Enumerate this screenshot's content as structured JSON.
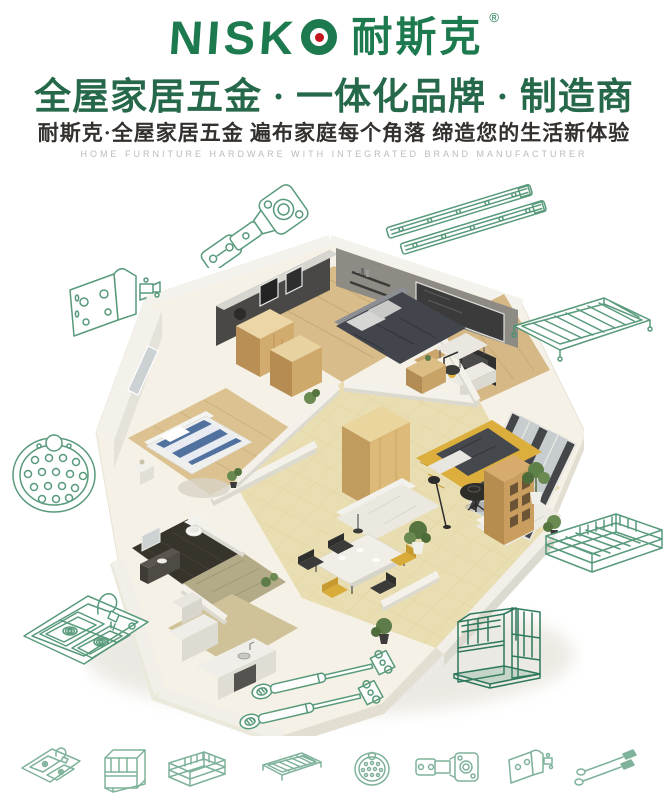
{
  "brand": {
    "wordmark": "NISKO",
    "wordmark_prefix": "NISK",
    "wordmark_last_letter": "O",
    "cn_name": "耐斯克",
    "registered_mark": "®"
  },
  "header": {
    "headline": "全屋家居五金 · 一体化品牌 · 制造商",
    "subheadline": "耐斯克·全屋家居五金  遍布家庭每个角落  缔造您的生活新体验",
    "tagline_en": "HOME FURNITURE HARDWARE WITH INTEGRATED BRAND MANUFACTURER"
  },
  "illustrations": {
    "center_image": "isometric-apartment-cutaway-render",
    "products_lineart": [
      "concealed-hinge",
      "drawer-slide-rails",
      "corner-bracket",
      "wire-shelf-rack",
      "perforated-round-plate",
      "wire-basket",
      "double-bowl-sink-with-faucet",
      "gas-lift-struts",
      "wire-organizer-rack"
    ],
    "bottom_icons": [
      "double-bowl-sink",
      "wire-organizer-rack",
      "wire-basket",
      "wire-shelf-rack",
      "perforated-round-plate",
      "concealed-hinge",
      "corner-bracket",
      "gas-lift-struts"
    ]
  },
  "colors": {
    "background": "#ffffff",
    "brand_green": "#1c7a4e",
    "headline_green": "#26684a",
    "accent_red": "#c3151c",
    "lineart_green": "#4a9270",
    "lineart_green_dark": "#1f6f52",
    "text_dark": "#33302e",
    "tagline_gray": "#bcbbb8"
  }
}
